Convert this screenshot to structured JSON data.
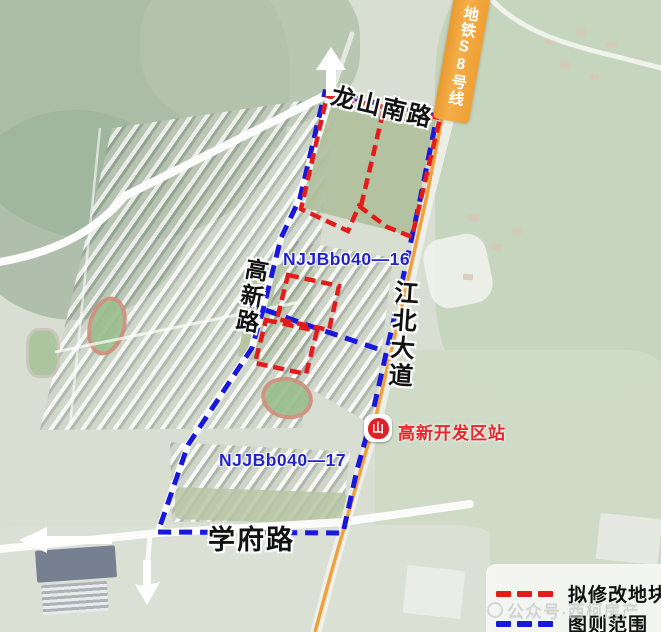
{
  "map": {
    "roads": {
      "longshan_south": "龙山南路",
      "gaoxin": "高新路",
      "jiangbei_avenue": "江北大道",
      "xuefu": "学府路"
    },
    "metro": {
      "line_label": "地铁S8号线",
      "station_label": "高新开发区站",
      "station_glyph": "山"
    },
    "parcels": {
      "p16": "NJJBb040—16",
      "p17": "NJJBb040—17"
    },
    "colors": {
      "scope_blue": "#1717dd",
      "modify_red": "#e31b1b",
      "metro_orange": "#f2a33c",
      "station_red": "#e8262a",
      "parcel_blue": "#2323cc"
    }
  },
  "legend": {
    "items": [
      {
        "id": "modify-plots",
        "label": "拟修改地块",
        "color": "#e31b1b",
        "style": "red-dashed"
      },
      {
        "id": "plan-scope",
        "label": "图则范围",
        "color": "#1717dd",
        "style": "blue-dashed"
      }
    ]
  },
  "watermark": {
    "text": "公众号·西柯房产"
  }
}
